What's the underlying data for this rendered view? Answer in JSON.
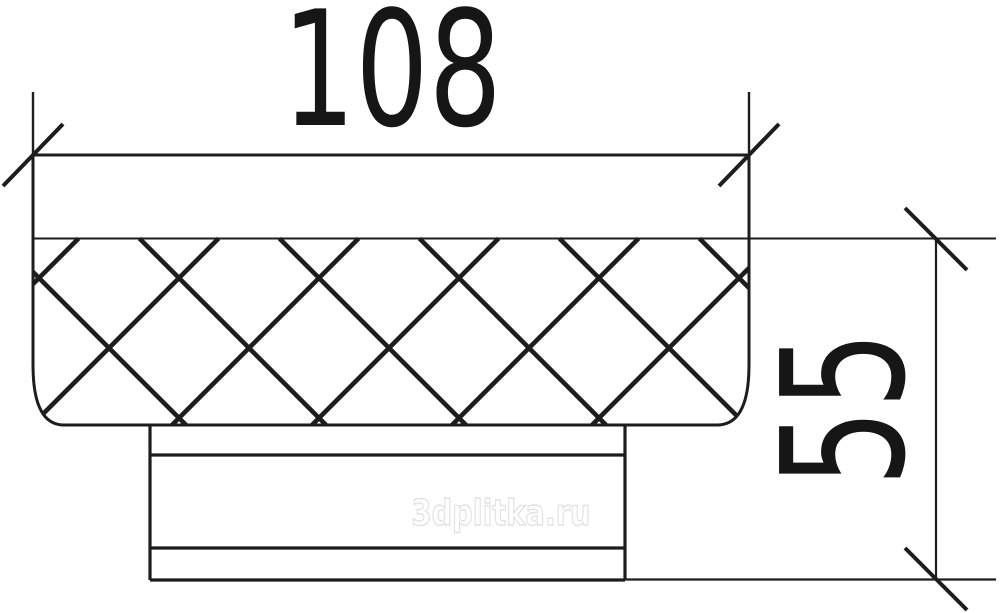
{
  "drawing": {
    "line_color": "#1d1d1d",
    "background": "#ffffff",
    "hatch_pattern": "diamond-crosshatch"
  },
  "dimensions": {
    "width": {
      "value_label": "108",
      "value": 108
    },
    "height": {
      "value_label": "55",
      "value": 55
    }
  },
  "watermark": {
    "text": "3dplitka.ru",
    "color": "#e2e2e2"
  }
}
